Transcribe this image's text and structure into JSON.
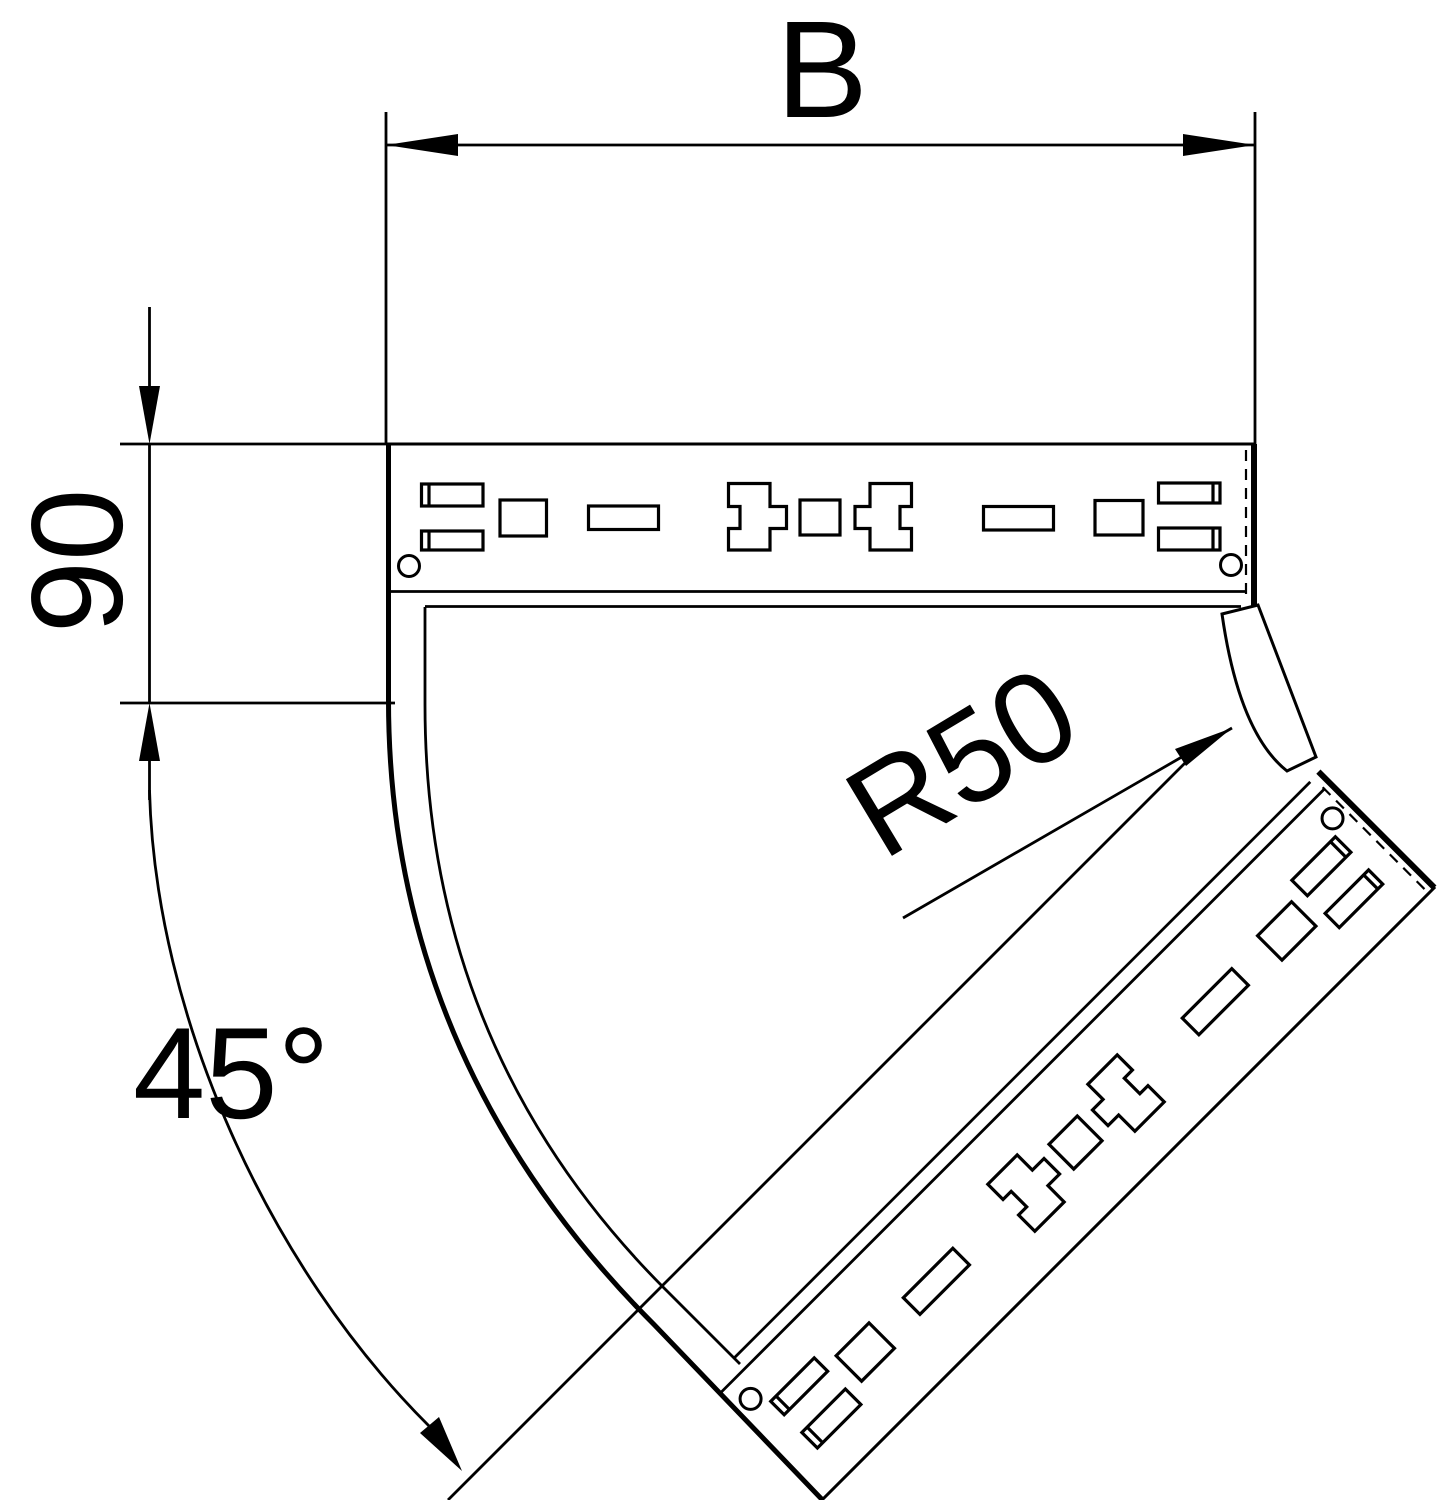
{
  "drawing": {
    "title_visible_text": "",
    "dimensions": {
      "width_label": "B",
      "straight_end_label": "90",
      "angle_label": "45°",
      "radius_label": "R50"
    },
    "colors": {
      "line": "#000000",
      "background": "#ffffff"
    }
  }
}
